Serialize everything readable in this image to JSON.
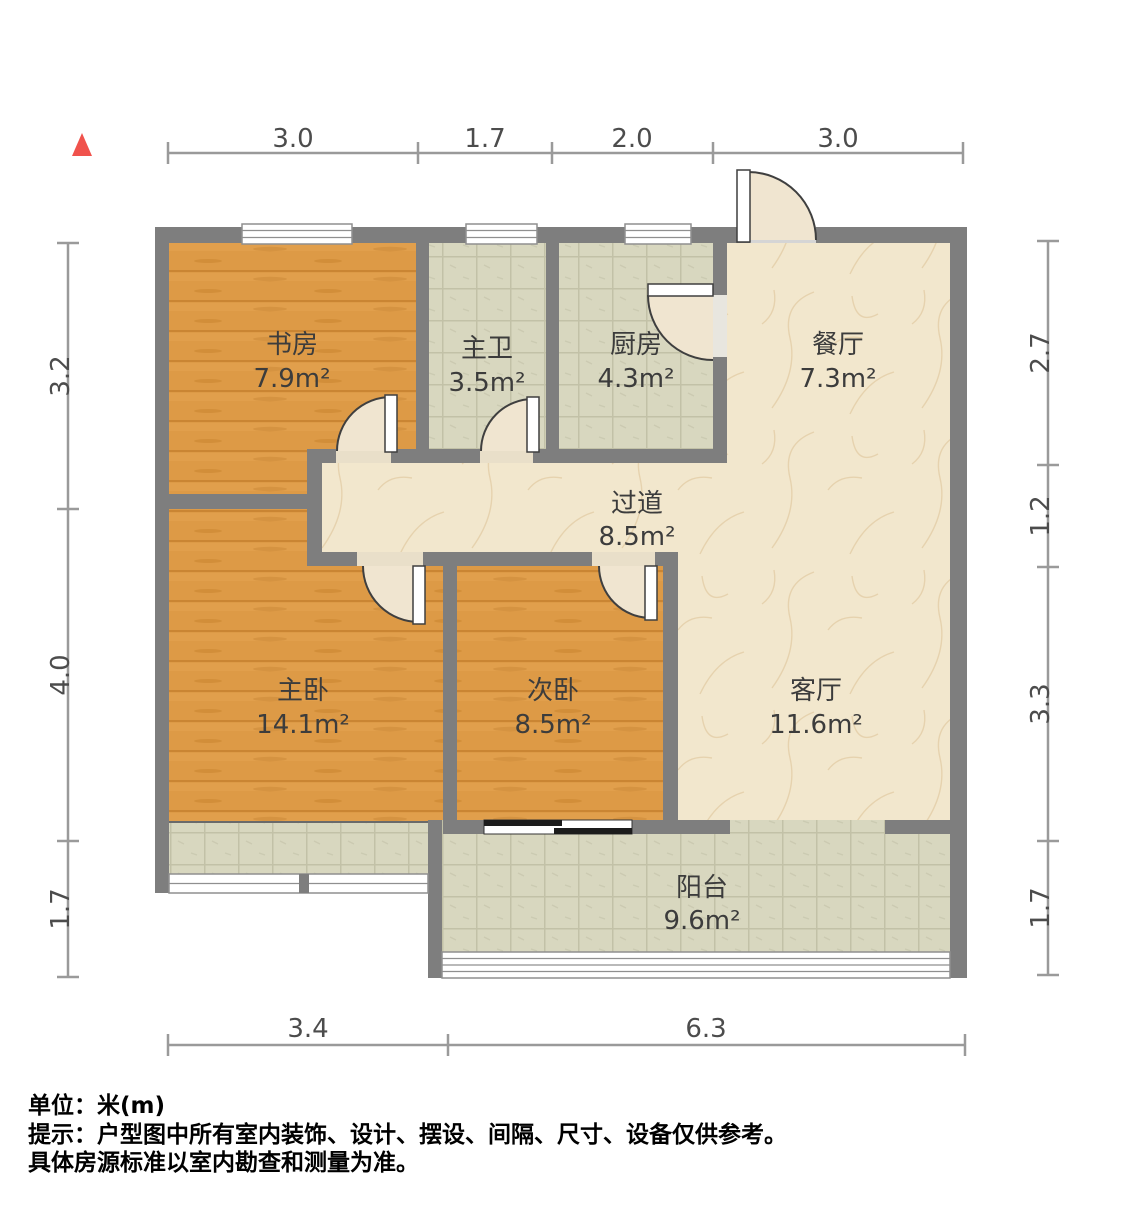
{
  "plan": {
    "rooms": [
      {
        "id": "study",
        "name": "书房",
        "area": "7.9m²"
      },
      {
        "id": "master-bath",
        "name": "主卫",
        "area": "3.5m²"
      },
      {
        "id": "kitchen",
        "name": "厨房",
        "area": "4.3m²"
      },
      {
        "id": "dining",
        "name": "餐厅",
        "area": "7.3m²"
      },
      {
        "id": "hallway",
        "name": "过道",
        "area": "8.5m²"
      },
      {
        "id": "master-bedroom",
        "name": "主卧",
        "area": "14.1m²"
      },
      {
        "id": "second-bedroom",
        "name": "次卧",
        "area": "8.5m²"
      },
      {
        "id": "living",
        "name": "客厅",
        "area": "11.6m²"
      },
      {
        "id": "balcony",
        "name": "阳台",
        "area": "9.6m²"
      }
    ],
    "dimensions": {
      "top": [
        "3.0",
        "1.7",
        "2.0",
        "3.0"
      ],
      "bottom": [
        "3.4",
        "6.3"
      ],
      "left": [
        "3.2",
        "4.0",
        "1.7"
      ],
      "right": [
        "2.7",
        "1.2",
        "3.3",
        "1.7"
      ]
    },
    "footer": {
      "unit": "单位：米(m)",
      "tip1": "提示：户型图中所有室内装饰、设计、摆设、间隔、尺寸、设备仅供参考。",
      "tip2": "具体房源标准以室内勘查和测量为准。"
    },
    "colors": {
      "wall": "#7e7e7e",
      "wood_floor": "#dd9a46",
      "tile_floor": "#d8d7bf",
      "marble_floor": "#f2e7cd",
      "door_swing": "#f0e5d0",
      "north_arrow": "#f0524c"
    }
  }
}
